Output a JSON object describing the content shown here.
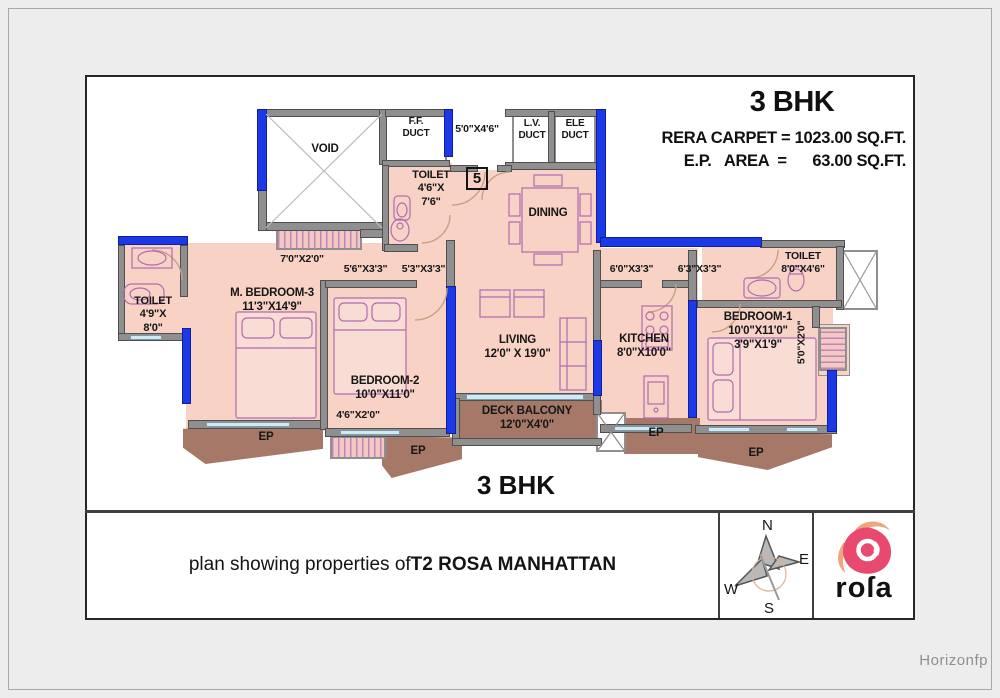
{
  "header": {
    "title": "3 BHK",
    "line1": "RERA CARPET = 1023.00 SQ.FT.",
    "line2": "E.P.   AREA  =      63.00 SQ.FT."
  },
  "plan": {
    "unit_number": "5",
    "bottom_label": "3 BHK",
    "rooms": {
      "void": {
        "name": "VOID"
      },
      "ff_duct": {
        "line1": "F.F.",
        "line2": "DUCT"
      },
      "lv_duct": {
        "line1": "L.V.",
        "line2": "DUCT"
      },
      "ele_duct": {
        "line1": "ELE",
        "line2": "DUCT"
      },
      "toilet_top": {
        "name": "TOILET",
        "dim1": "4'6\"X",
        "dim2": "7'6\""
      },
      "dining": {
        "name": "DINING"
      },
      "toilet_left": {
        "name": "TOILET",
        "dim1": "4'9\"X",
        "dim2": "8'0\""
      },
      "m_bedroom3": {
        "name": "M. BEDROOM-3",
        "dim": "11'3\"X14'9\""
      },
      "bedroom2": {
        "name": "BEDROOM-2",
        "dim": "10'0\"X11'0\""
      },
      "living": {
        "name": "LIVING",
        "dim": "12'0\" X 19'0\""
      },
      "kitchen": {
        "name": "KITCHEN",
        "dim": "8'0\"X10'0\""
      },
      "bedroom1": {
        "name": "BEDROOM-1",
        "dim1": "10'0\"X11'0\"",
        "dim2": "3'9\"X1'9\""
      },
      "toilet_right": {
        "name": "TOILET",
        "dim": "8'0\"X4'6\""
      },
      "deck_balcony": {
        "name": "DECK BALCONY",
        "dim": "12'0\"X4'0\""
      },
      "ep": "EP"
    },
    "dims": {
      "lobby": "5'0\"X4'6\"",
      "ledge_top_left": "7'0\"X2'0\"",
      "pass1": "5'6\"X3'3\"",
      "pass2": "5'3\"X3'3\"",
      "pass3": "6'0\"X3'3\"",
      "pass4": "6'3\"X3'3\"",
      "ledge_bottom": "4'6\"X2'0\"",
      "ledge_right": "5'0\"X2'0\""
    }
  },
  "footer": {
    "caption_regular": "plan showing properties of ",
    "caption_bold": "T2 ROSA MANHATTAN"
  },
  "compass": {
    "n": "N",
    "e": "E",
    "s": "S",
    "w": "W"
  },
  "logo": {
    "text": "roſa"
  },
  "watermark": "Horizonfp",
  "colors": {
    "wall_blue": "#1c39e8",
    "room_pink": "#f8d3c5",
    "balcony_brown": "#a57868",
    "logo_pink": "#e84a6f",
    "logo_salmon": "#efa57e"
  }
}
